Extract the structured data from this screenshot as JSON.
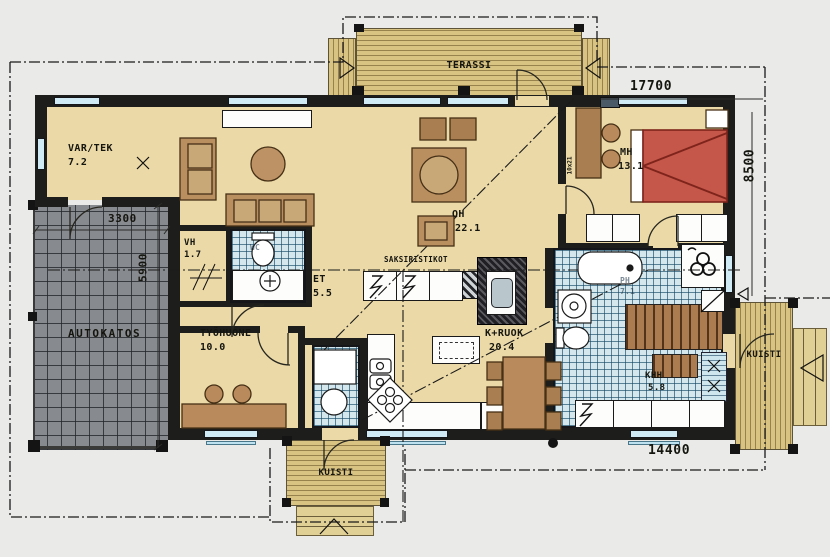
{
  "rooms": {
    "vartek": {
      "name": "VAR/TEK",
      "area": "7.2"
    },
    "terassi": {
      "name": "TERASSI"
    },
    "oh": {
      "name": "OH",
      "area": "22.1"
    },
    "mh": {
      "name": "MH",
      "area": "13.1"
    },
    "vh": {
      "name": "VH",
      "area": "1.7"
    },
    "wc": {
      "name": "WC"
    },
    "et": {
      "name": "ET",
      "area": "5.5"
    },
    "tyohuone": {
      "name": "TYÖHUONE",
      "area": "10.0"
    },
    "autokatos": {
      "name": "AUTOKATOS"
    },
    "kruok": {
      "name": "K+RUOK",
      "area": "20.4"
    },
    "ph": {
      "name": "PH",
      "area": "7.1"
    },
    "khh": {
      "name": "KHH",
      "area": "5.8"
    },
    "kuisti_right": {
      "name": "KUISTI"
    },
    "kuisti_bottom": {
      "name": "KUISTI"
    }
  },
  "annotations": {
    "truss": "SAKSIRISTIKOT",
    "door_mark": "10x21"
  },
  "dimensions": {
    "total_width": "17700",
    "depth": "8500",
    "house_width": "14400",
    "carport_width": "3300",
    "carport_depth": "5900"
  },
  "colors": {
    "floor": "#ebd9a7",
    "wall": "#1d1d1b",
    "tile": "#d3e7ec",
    "deck": "#d8c383",
    "carport": "#878a8f",
    "bed": "#c5564a",
    "furniture": "#b98f60",
    "window": "#cfeaf5"
  }
}
